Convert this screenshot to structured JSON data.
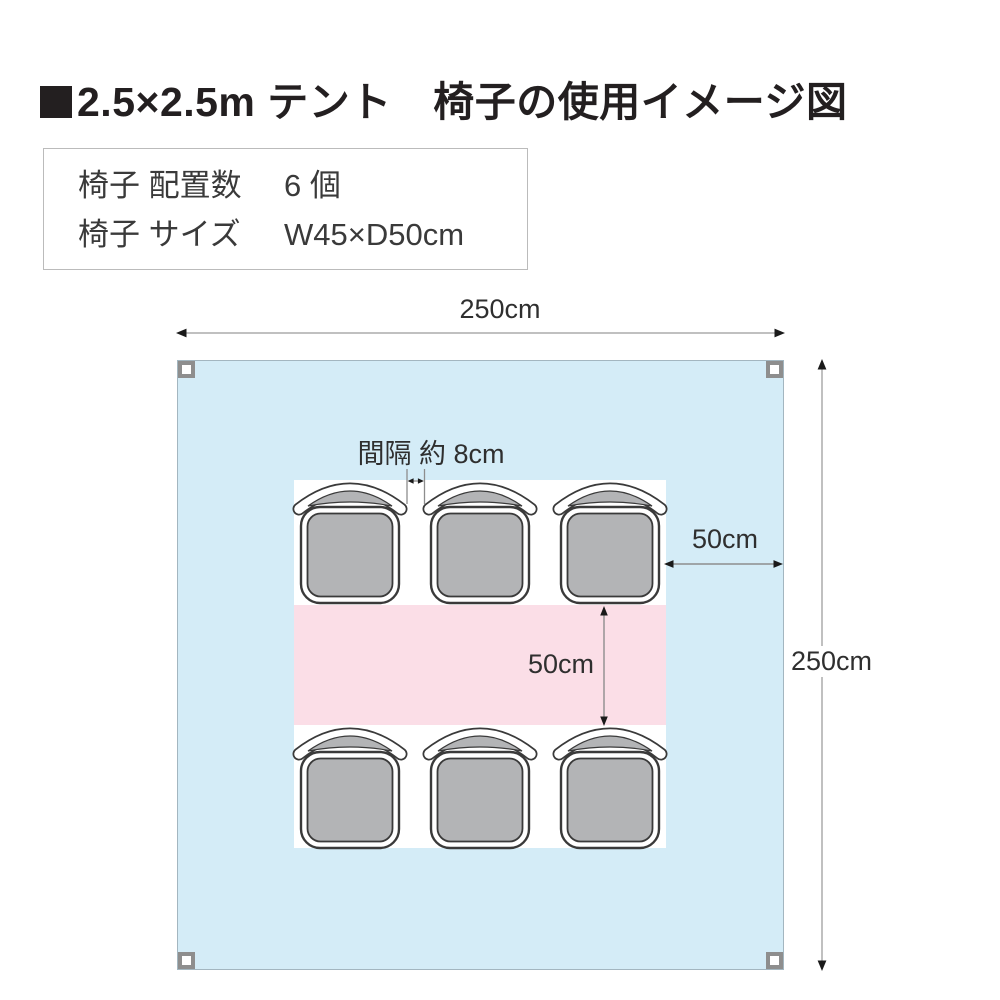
{
  "title": {
    "bullet": "■",
    "text": "2.5×2.5m テント　椅子の使用イメージ図"
  },
  "info_box": {
    "rows": [
      {
        "label": "椅子 配置数",
        "value": "6 個"
      },
      {
        "label": "椅子 サイズ",
        "value": "W45×D50cm"
      }
    ]
  },
  "dimensions": {
    "tent_width": "250cm",
    "tent_height": "250cm",
    "side_margin": "50cm",
    "row_spacing": "50cm",
    "chair_gap": "間隔 約 8cm"
  },
  "layout": {
    "chair_count": 6,
    "chair_rows": 2,
    "chairs_per_row": 3
  },
  "colors": {
    "tent_fill": "#d4ecf7",
    "aisle_fill": "#fbdee7",
    "chair_fill": "#b3b4b6",
    "chair_outline": "#3a3a3a",
    "leg_border": "#8e8e8e",
    "dim_line": "#ababab",
    "dim_line2": "#8d8d8d",
    "arrow_head": "#1a1a1a",
    "text_dark": "#2f2f2f",
    "title_color": "#231f20",
    "box_border": "#bbbbbb",
    "info_text": "#3a3a3a"
  }
}
